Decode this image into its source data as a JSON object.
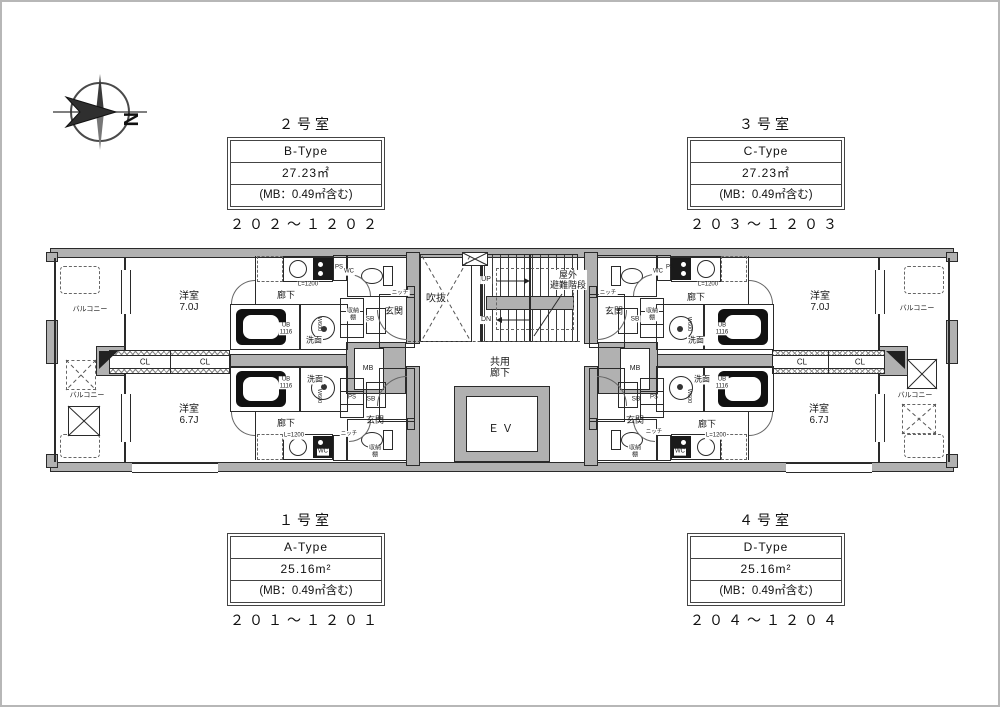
{
  "page": {
    "background": "#ffffff",
    "frame_color": "#b7b7b7",
    "line_color": "#2a2a2a",
    "wall_color": "#b1b1b1"
  },
  "compass": {
    "north_label": "N"
  },
  "unit_blocks": [
    {
      "title": "２号室",
      "type": "B-Type",
      "area": "27.23㎡",
      "mb": "(MB：0.49㎡含む)",
      "range": "２０２～１２０２"
    },
    {
      "title": "３号室",
      "type": "C-Type",
      "area": "27.23㎡",
      "mb": "(MB：0.49㎡含む)",
      "range": "２０３～１２０３"
    },
    {
      "title": "１号室",
      "type": "A-Type",
      "area": "25.16m²",
      "mb": "(MB：0.49㎡含む)",
      "range": "２０１～１２０１"
    },
    {
      "title": "４号室",
      "type": "D-Type",
      "area": "25.16m²",
      "mb": "(MB：0.49㎡含む)",
      "range": "２０４～１２０４"
    }
  ],
  "plan": {
    "labels": [
      {
        "t": "バルコニー",
        "x": 88,
        "y": 308,
        "fs": 7
      },
      {
        "t": "バルコニー",
        "x": 85,
        "y": 394,
        "fs": 7
      },
      {
        "t": "洋室\n7.0J",
        "x": 187,
        "y": 300,
        "fs": 10
      },
      {
        "t": "CL",
        "x": 143,
        "y": 361,
        "fs": 8,
        "bg": 1
      },
      {
        "t": "CL",
        "x": 203,
        "y": 361,
        "fs": 8,
        "bg": 1
      },
      {
        "t": "洋室\n6.7J",
        "x": 187,
        "y": 413,
        "fs": 10
      },
      {
        "t": "廊下",
        "x": 284,
        "y": 293,
        "fs": 9
      },
      {
        "t": "L=1200",
        "x": 306,
        "y": 283,
        "fs": 6,
        "bg": 1
      },
      {
        "t": "PS",
        "x": 337,
        "y": 266,
        "fs": 6
      },
      {
        "t": "WC",
        "x": 347,
        "y": 270,
        "fs": 6,
        "bg": 1
      },
      {
        "t": "ニッチ",
        "x": 398,
        "y": 291,
        "fs": 5.5,
        "bg": 1
      },
      {
        "t": "玄関",
        "x": 392,
        "y": 309,
        "fs": 9
      },
      {
        "t": "収納\n棚",
        "x": 351,
        "y": 313,
        "fs": 6,
        "bg": 1
      },
      {
        "t": "SB",
        "x": 368,
        "y": 317,
        "fs": 6.5,
        "bg": 1
      },
      {
        "t": "洗面",
        "x": 312,
        "y": 339,
        "fs": 8,
        "bg": 1
      },
      {
        "t": "W600",
        "x": 317,
        "y": 322,
        "fs": 5.5,
        "rot": 90
      },
      {
        "t": "UB\n1116",
        "x": 284,
        "y": 327,
        "fs": 6,
        "bg": 1
      },
      {
        "t": "MB",
        "x": 366,
        "y": 367,
        "fs": 7
      },
      {
        "t": "PS",
        "x": 350,
        "y": 396,
        "fs": 6
      },
      {
        "t": "SB",
        "x": 369,
        "y": 397,
        "fs": 6.5
      },
      {
        "t": "UB\n1116",
        "x": 284,
        "y": 381,
        "fs": 6,
        "bg": 1
      },
      {
        "t": "洗面",
        "x": 313,
        "y": 378,
        "fs": 8,
        "bg": 1
      },
      {
        "t": "W600",
        "x": 317,
        "y": 394,
        "fs": 5.5,
        "rot": 90
      },
      {
        "t": "玄関",
        "x": 373,
        "y": 418,
        "fs": 9
      },
      {
        "t": "廊下",
        "x": 284,
        "y": 421,
        "fs": 9
      },
      {
        "t": "L=1200",
        "x": 292,
        "y": 434,
        "fs": 6,
        "bg": 1
      },
      {
        "t": "WC",
        "x": 321,
        "y": 450,
        "fs": 6,
        "bg": 1
      },
      {
        "t": "収納\n棚",
        "x": 373,
        "y": 450,
        "fs": 6,
        "bg": 1
      },
      {
        "t": "ニッチ",
        "x": 347,
        "y": 432,
        "fs": 5.5,
        "bg": 1
      },
      {
        "t": "吹抜",
        "x": 434,
        "y": 297,
        "fs": 10,
        "bg": 1
      },
      {
        "t": "UP",
        "x": 484,
        "y": 278,
        "fs": 7,
        "bg": 1
      },
      {
        "t": "DN",
        "x": 484,
        "y": 318,
        "fs": 7,
        "bg": 1
      },
      {
        "t": "屋外\n避難階段",
        "x": 566,
        "y": 278,
        "fs": 9,
        "bg": 1
      },
      {
        "t": "共用\n廊下",
        "x": 498,
        "y": 366,
        "fs": 10
      },
      {
        "t": "ＥＶ",
        "x": 500,
        "y": 427,
        "fs": 11,
        "ls": 3
      },
      {
        "t": "SB",
        "x": 633,
        "y": 317,
        "fs": 6.5,
        "bg": 1
      },
      {
        "t": "収納\n棚",
        "x": 650,
        "y": 313,
        "fs": 6,
        "bg": 1
      },
      {
        "t": "MB",
        "x": 633,
        "y": 367,
        "fs": 7
      },
      {
        "t": "SB",
        "x": 634,
        "y": 397,
        "fs": 6.5
      },
      {
        "t": "PS",
        "x": 652,
        "y": 396,
        "fs": 6
      },
      {
        "t": "WC",
        "x": 656,
        "y": 270,
        "fs": 6,
        "bg": 1
      },
      {
        "t": "PS",
        "x": 668,
        "y": 266,
        "fs": 6
      },
      {
        "t": "L=1200",
        "x": 706,
        "y": 283,
        "fs": 6,
        "bg": 1
      },
      {
        "t": "ニッチ",
        "x": 606,
        "y": 291,
        "fs": 5.5,
        "bg": 1
      },
      {
        "t": "玄関",
        "x": 612,
        "y": 309,
        "fs": 9
      },
      {
        "t": "洗面",
        "x": 694,
        "y": 339,
        "fs": 8,
        "bg": 1
      },
      {
        "t": "W600",
        "x": 687,
        "y": 322,
        "fs": 5.5,
        "rot": 90
      },
      {
        "t": "廊下",
        "x": 694,
        "y": 295,
        "fs": 9
      },
      {
        "t": "UB\n1116",
        "x": 720,
        "y": 327,
        "fs": 6,
        "bg": 1
      },
      {
        "t": "玄関",
        "x": 633,
        "y": 418,
        "fs": 9
      },
      {
        "t": "洗面",
        "x": 700,
        "y": 378,
        "fs": 8,
        "bg": 1
      },
      {
        "t": "W600",
        "x": 687,
        "y": 394,
        "fs": 5.5,
        "rot": 90
      },
      {
        "t": "UB\n1116",
        "x": 720,
        "y": 381,
        "fs": 6,
        "bg": 1
      },
      {
        "t": "廊下",
        "x": 705,
        "y": 422,
        "fs": 9
      },
      {
        "t": "収納\n棚",
        "x": 633,
        "y": 450,
        "fs": 6,
        "bg": 1
      },
      {
        "t": "WC",
        "x": 678,
        "y": 450,
        "fs": 6,
        "bg": 1
      },
      {
        "t": "L=1200",
        "x": 714,
        "y": 434,
        "fs": 6,
        "bg": 1
      },
      {
        "t": "ニッチ",
        "x": 652,
        "y": 430,
        "fs": 5.5,
        "bg": 1
      },
      {
        "t": "洋室\n7.0J",
        "x": 818,
        "y": 300,
        "fs": 10
      },
      {
        "t": "CL",
        "x": 800,
        "y": 361,
        "fs": 8,
        "bg": 1
      },
      {
        "t": "CL",
        "x": 858,
        "y": 361,
        "fs": 8,
        "bg": 1
      },
      {
        "t": "洋室\n6.7J",
        "x": 817,
        "y": 413,
        "fs": 10
      },
      {
        "t": "バルコニー",
        "x": 915,
        "y": 307,
        "fs": 7
      },
      {
        "t": "バルコニー",
        "x": 913,
        "y": 394,
        "fs": 7
      }
    ]
  }
}
